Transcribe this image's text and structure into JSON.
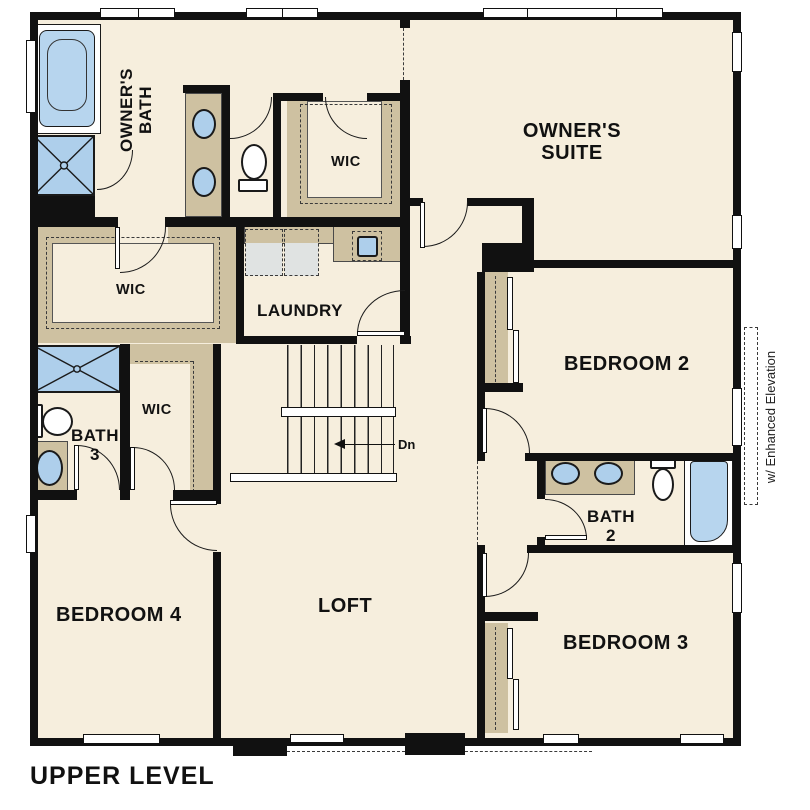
{
  "title": "UPPER LEVEL",
  "rooms": {
    "owners_suite": {
      "line1": "OWNER'S",
      "line2": "SUITE"
    },
    "owners_bath": {
      "line1": "OWNER'S",
      "line2": "BATH"
    },
    "wic_owners": {
      "label": "WIC"
    },
    "wic_hall": {
      "label": "WIC"
    },
    "laundry": {
      "label": "LAUNDRY"
    },
    "bedroom2": {
      "label": "BEDROOM 2"
    },
    "bath2": {
      "line1": "BATH",
      "line2": "2"
    },
    "bedroom3": {
      "label": "BEDROOM 3"
    },
    "wic_bedroom4": {
      "label": "WIC"
    },
    "bath3": {
      "line1": "BATH",
      "line2": "3"
    },
    "bedroom4": {
      "label": "BEDROOM 4"
    },
    "loft": {
      "label": "LOFT"
    }
  },
  "annotations": {
    "stairs_direction": "Dn",
    "elevation_note": "w/ Enhanced Elevation"
  },
  "colors": {
    "floor": "#f6eedd",
    "wall": "#111111",
    "cabinet_tan": "#cec1a1",
    "fixture_blue": "#aecfeb",
    "appliance_gray": "#e0e3e2"
  }
}
